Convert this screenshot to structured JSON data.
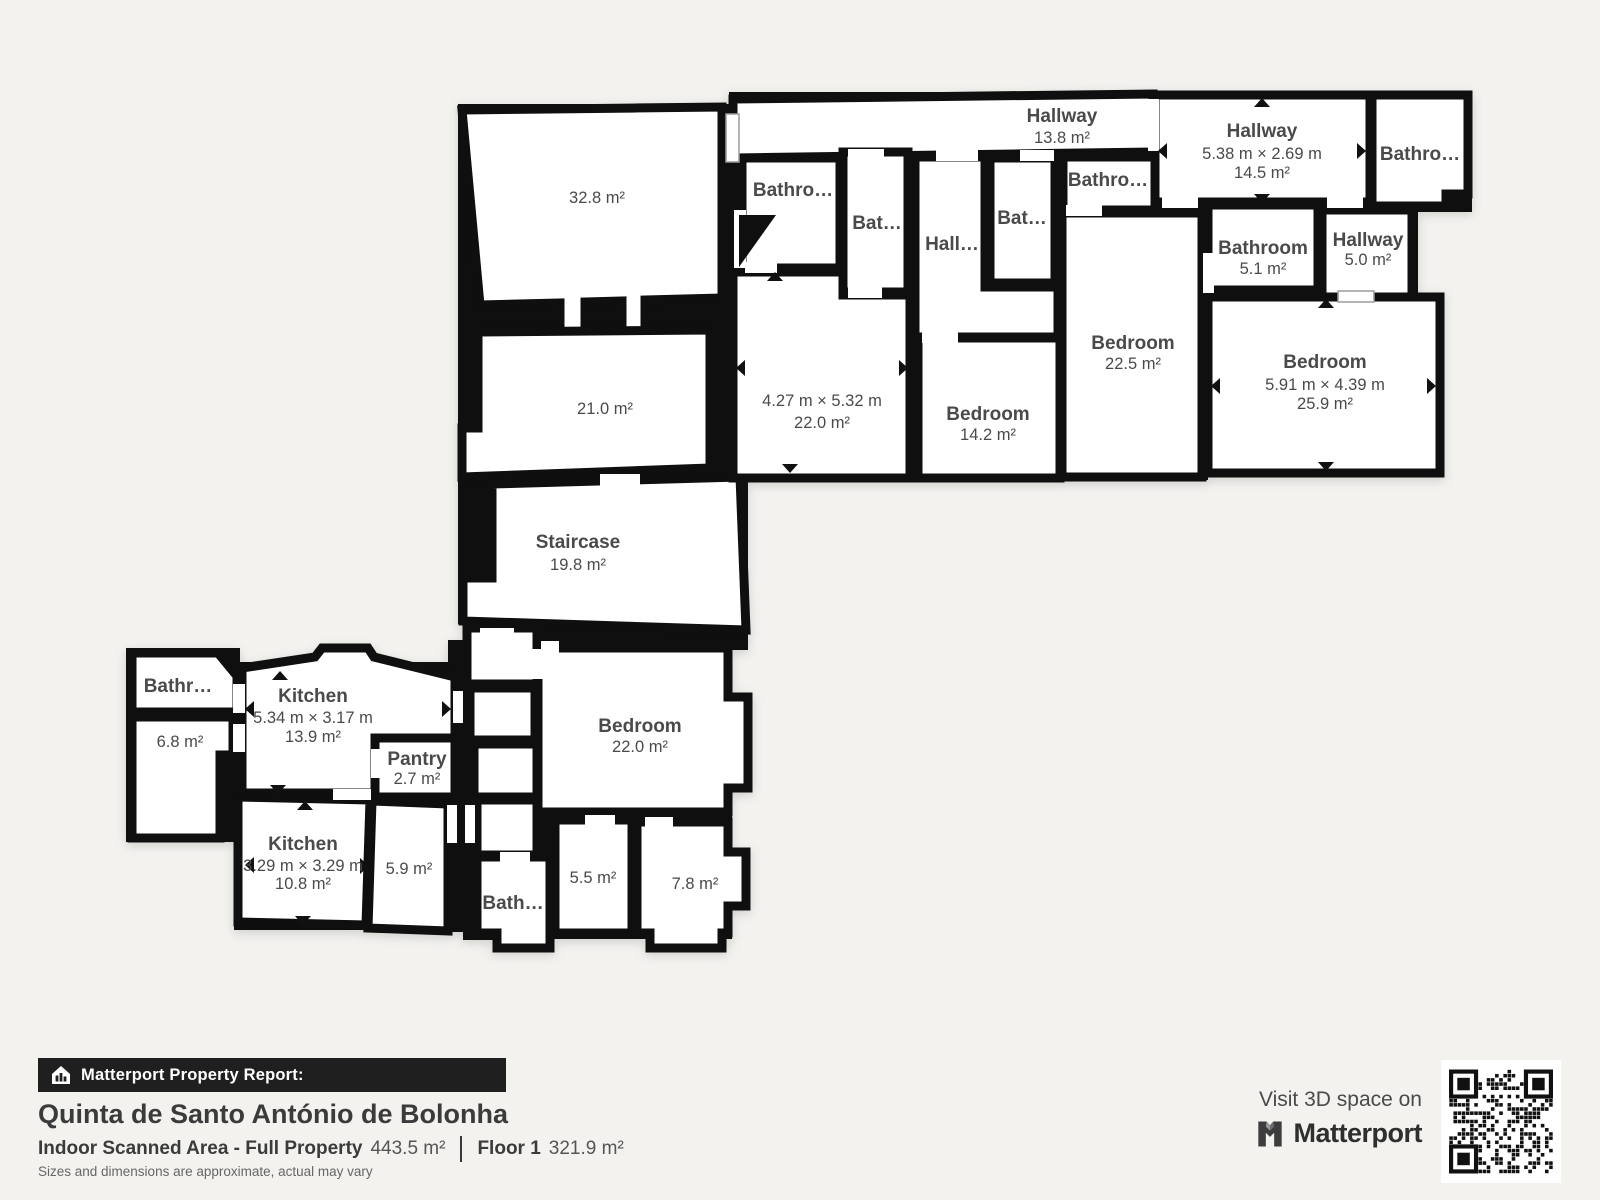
{
  "colors": {
    "background": "#f3f2ef",
    "wall": "#0f0f0f",
    "room_fill": "#ffffff",
    "label": "#4a4a4a",
    "bar_bg": "#1f1f1f",
    "bar_text": "#ffffff"
  },
  "plan": {
    "rooms": [
      {
        "area": "32.8 m²"
      },
      {
        "area": "21.0 m²"
      },
      {
        "name": "Staircase",
        "area": "19.8 m²"
      },
      {
        "name": "Hallway",
        "area": "13.8 m²"
      },
      {
        "name": "Hallway",
        "dims": "5.38 m × 2.69 m",
        "area": "14.5 m²"
      },
      {
        "name": "Bathro…"
      },
      {
        "name": "Bathro…"
      },
      {
        "name": "Bat…"
      },
      {
        "name": "Hall…"
      },
      {
        "name": "Bat…"
      },
      {
        "name": "Bathro…"
      },
      {
        "name": "Bathroom",
        "area": "5.1 m²"
      },
      {
        "name": "Hallway",
        "area": "5.0 m²"
      },
      {
        "name": "Bedroom",
        "area": "22.5 m²"
      },
      {
        "name": "Bedroom",
        "dims": "5.91 m × 4.39 m",
        "area": "25.9 m²"
      },
      {
        "dims": "4.27 m × 5.32 m",
        "area": "22.0 m²"
      },
      {
        "name": "Bedroom",
        "area": "14.2 m²"
      },
      {
        "name": "Bathr…"
      },
      {
        "area": "6.8 m²"
      },
      {
        "name": "Kitchen",
        "dims": "5.34 m × 3.17 m",
        "area": "13.9 m²"
      },
      {
        "name": "Pantry",
        "area": "2.7 m²"
      },
      {
        "name": "Kitchen",
        "dims": "3.29 m × 3.29 m",
        "area": "10.8 m²"
      },
      {
        "area": "5.9 m²"
      },
      {
        "name": "Bedroom",
        "area": "22.0 m²"
      },
      {
        "name": "Bath…"
      },
      {
        "area": "5.5 m²"
      },
      {
        "area": "7.8 m²"
      }
    ]
  },
  "footer": {
    "report_label": "Matterport Property Report:",
    "property_name": "Quinta de Santo António de Bolonha",
    "scanned_area_label": "Indoor Scanned Area - Full Property",
    "scanned_area_value": "443.5 m²",
    "floor_label": "Floor 1",
    "floor_value": "321.9 m²",
    "disclaimer": "Sizes and dimensions are approximate, actual may vary"
  },
  "cta": {
    "visit_text": "Visit 3D space on",
    "brand_name": "Matterport",
    "icons": {
      "report": "house-report-icon",
      "brand": "matterport-m-icon",
      "qr": "qr-code"
    }
  }
}
